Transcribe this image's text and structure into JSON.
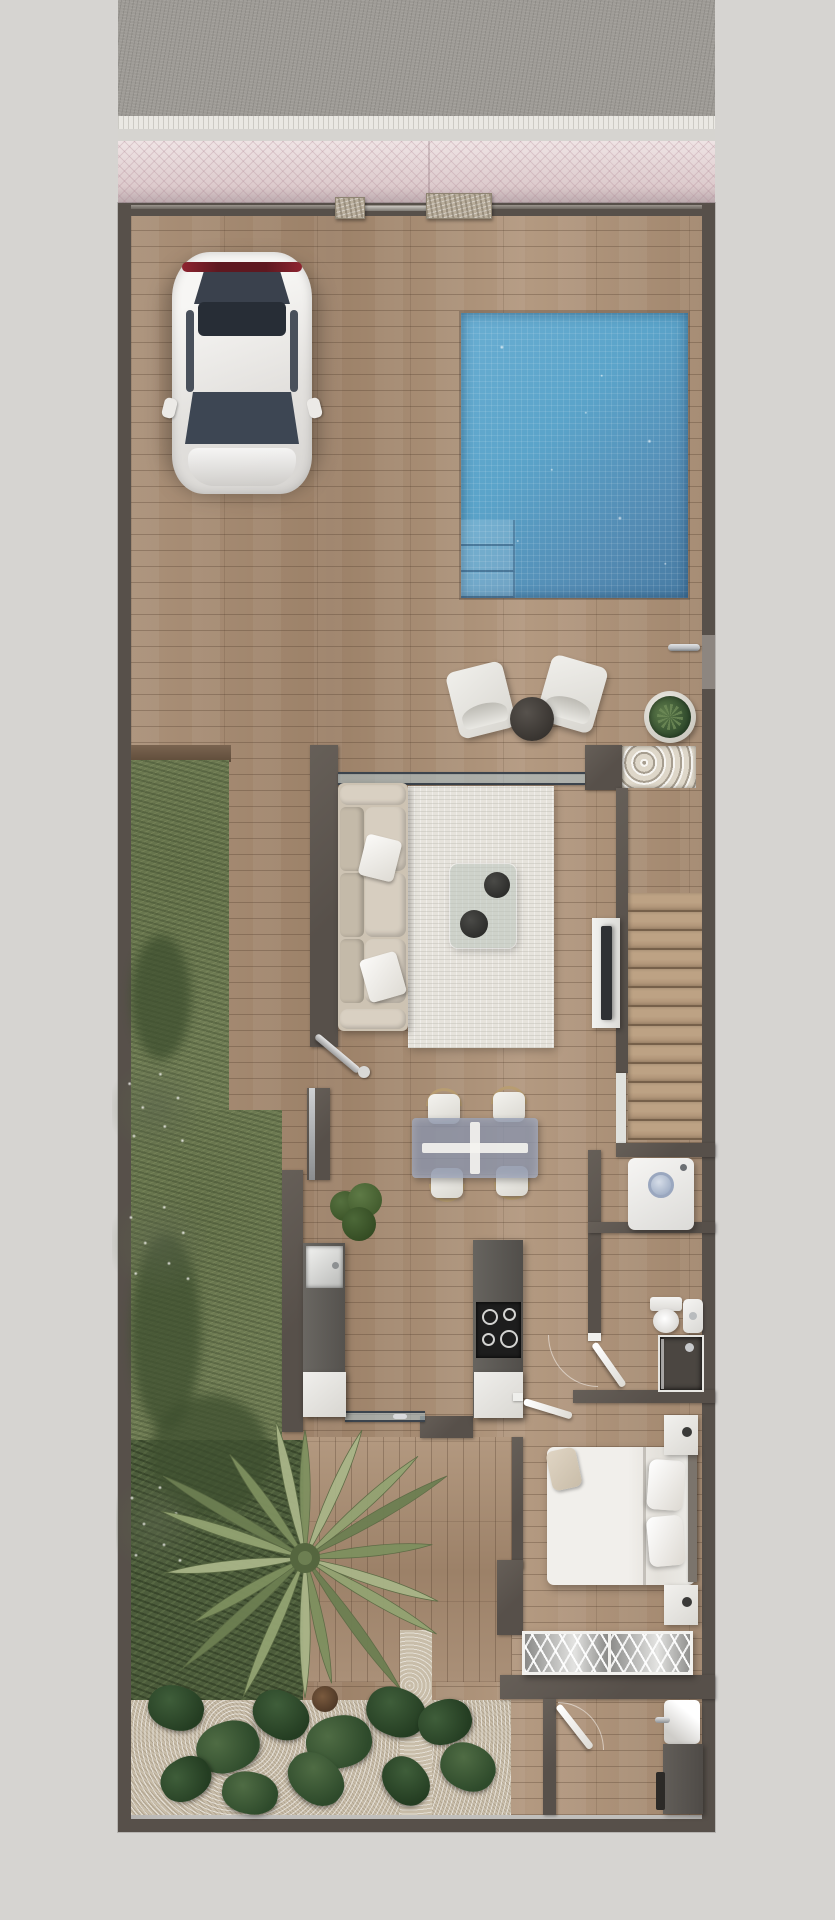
{
  "scene": {
    "type": "architectural-floor-plan-top-view-render",
    "description": "Top-down 3D render of a narrow single-storey villa plot with driveway, pool, garden and furnished interior. No text is visible in the image.",
    "exterior": {
      "street": [
        "asphalt-road",
        "white-curb",
        "concrete-strip",
        "pink-herringbone-paving"
      ],
      "entrance": {
        "stone_pillars": 2,
        "gate": 1
      },
      "driveway": {
        "car": "white-hatchback-top-view",
        "floor": "wood-plank-decking"
      },
      "pool": {
        "shape": "rectangle",
        "steps": 3,
        "finish": "blue-mosaic-with-sparkles"
      },
      "lounge": {
        "outdoor_chairs": 2,
        "round_side_table": 1,
        "potted_plant": 1,
        "pebble_bed": 1,
        "side_door_handle": 1
      },
      "garden": {
        "grass_strip": true,
        "flower_clusters": 3,
        "palm_tree": 1,
        "monstera_bed": true,
        "gravel_path": true,
        "wood_deck": true
      }
    },
    "interior": {
      "living_room": {
        "sofa_seats": 3,
        "pillows": 2,
        "rug": 1,
        "glass_coffee_table": 1,
        "bowls_on_table": 2,
        "floor_lamp": 1,
        "tv_console": 1,
        "tv": 1,
        "sliding_glass_walls": 2
      },
      "dining": {
        "glass_table": 1,
        "chairs": 4,
        "table_cross_base": true
      },
      "kitchen": {
        "counter_with_sink": 1,
        "island_with_cooktop": 1,
        "cooktop_burners": 4,
        "white_base_cabinets": 2,
        "plant": 1
      },
      "stairs": {
        "treads": 13
      },
      "utility": {
        "washing_machine": 1
      },
      "bathroom": {
        "toilet": 1,
        "sink": 1,
        "shower": 1,
        "door": 1
      },
      "bedroom": {
        "double_bed": 1,
        "pillows": 2,
        "nightstands": 2,
        "wardrobe_sections": 2,
        "door": 1
      },
      "lower_washroom": {
        "sink_vanity": 1,
        "counter": 1,
        "door": 1
      }
    }
  },
  "palette": {
    "bg": "#d6d4d1",
    "road": "#9d9a95",
    "curb": "#eae8e3",
    "concrete": "#d6d4d0",
    "paving_pink": "#e8d8d9",
    "wall": "#57504a",
    "wall_light": "#8d8680",
    "wood": "#a88e76",
    "stone": "#b9ae9c",
    "pebbles": "#ded7c9",
    "pool_blue": "#5ba4ca",
    "pool_deep": "#477ba3",
    "grass": "#6f7c54",
    "green_dark": "#4c5c3b",
    "gravel": "#c8bda9",
    "rug": "#e6e3dc",
    "sofa": "#cdc3b3",
    "dining_glass": "#8a92a8",
    "chrome": "#b9bcc0",
    "tv": "#2f3134",
    "cooktop": "#1d1d1d",
    "red_tail": "#8e2430",
    "soil": "#6b5844",
    "palm": "#7e905f",
    "palm_light": "#a9b588",
    "monstera": "#2f4a2e"
  }
}
